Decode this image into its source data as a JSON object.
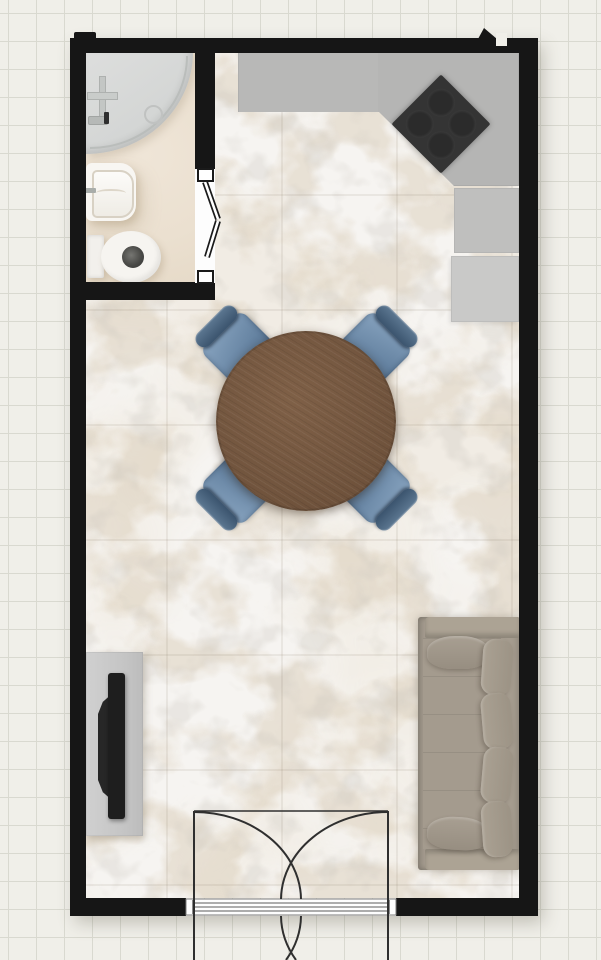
{
  "scene": {
    "type": "floor-plan",
    "view": "top-down-2d",
    "canvas": {
      "width_px": 601,
      "height_px": 960,
      "background_color": "#f0efe9",
      "grid_cell_px": 28,
      "grid_line_color": "#d9d9d0"
    },
    "walls": {
      "color": "#161616",
      "thickness_px": 17
    },
    "rooms": [
      {
        "name": "bathroom",
        "position": "top-left",
        "floor_color": "#ebe0d0",
        "fixtures": [
          {
            "name": "corner-shower",
            "shape": "quarter-circle",
            "color": "#d6d8d7",
            "drain": true,
            "wall_valve": true
          },
          {
            "name": "wash-basin",
            "color": "#f8f6f2",
            "mounted": "left-wall"
          },
          {
            "name": "toilet",
            "color": "#f6f4f0",
            "bowl_hole_color": "#4a4a47",
            "tank_against": "left-wall"
          }
        ],
        "door": {
          "type": "bifold",
          "location": "right-wall",
          "pivot_color": "#ffffff",
          "outline_color": "#1a1a1a"
        }
      },
      {
        "name": "main-room",
        "floor": "white-marble-tile",
        "floor_base_color": "#f6f4f1",
        "vein_colors": [
          "#a8937a",
          "#8d8070"
        ],
        "tile_grid_px": 115,
        "zones": [
          "kitchen",
          "dining",
          "living"
        ]
      }
    ],
    "kitchen": {
      "counter": {
        "shape": "L-with-angled-corner",
        "color": "#b5b5b4",
        "location": "top-right"
      },
      "cooktop": {
        "color": "#343434",
        "burners": 4,
        "rotation_deg": 45
      },
      "base_cabinet": {
        "color": "#bfbfbe"
      },
      "refrigerator": {
        "color": "#c9c9c8"
      }
    },
    "dining": {
      "table": {
        "shape": "round",
        "material": "wood",
        "color": "#73563f",
        "diameter_px": 180
      },
      "chairs": {
        "count": 4,
        "seat_color": "#6f8dab",
        "back_color": "#43607e",
        "arrangement": "diagonal-45deg"
      }
    },
    "living": {
      "sofa": {
        "color": "#a59c8f",
        "against": "right-wall",
        "back_pillows": 4,
        "seat_cushions": 2
      },
      "tv_stand": {
        "color": "#c6c6c6",
        "against": "left-wall"
      },
      "tv": {
        "color": "#1e1e1e"
      }
    },
    "entry_door": {
      "type": "double-swing",
      "location": "bottom-wall",
      "leaves": 2,
      "swing_arc_color": "#2f2f2f",
      "threshold_color": "#fdfdfd"
    }
  }
}
